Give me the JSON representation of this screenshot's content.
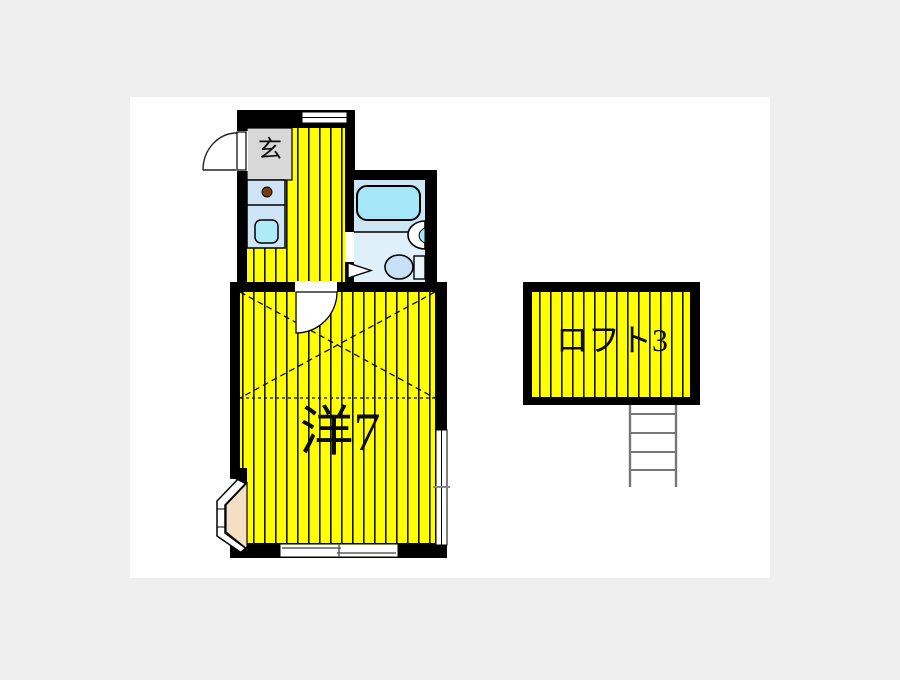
{
  "page": {
    "background_color": "#efefef",
    "canvas_color": "#ffffff"
  },
  "floorplan": {
    "kind": "japanese-apartment-floor-plan",
    "labels": {
      "entrance": "玄",
      "main_room": "洋7",
      "loft": "ロフト3"
    },
    "rooms": [
      {
        "id": "entrance-hall",
        "label": "玄"
      },
      {
        "id": "kitchen-corridor",
        "label": ""
      },
      {
        "id": "bathroom",
        "label": ""
      },
      {
        "id": "western-room",
        "label": "洋7",
        "size_mats": 7
      },
      {
        "id": "loft",
        "label": "ロフト3",
        "size_mats": 3
      }
    ],
    "fixtures": [
      "entrance-door",
      "kitchen-counter",
      "stove-burner",
      "kitchen-sink",
      "top-window",
      "bathtub",
      "washbasin",
      "toilet",
      "bathroom-door",
      "room-door",
      "loft-outline-dashed",
      "bay-window",
      "sliding-window-bottom",
      "sliding-window-right",
      "loft-ladder"
    ],
    "colors": {
      "wall": "#000000",
      "flooring_yellow": "#ffff00",
      "stripe_line": "#151500",
      "genkan_gray": "#d8d8d8",
      "counter_blue": "#cfe4f6",
      "sink_cyan": "#aeeaf7",
      "bathroom_floor": "#dff0fb",
      "bath_zone": "#cde6f5",
      "bathtub_cyan": "#a5e7f8",
      "toilet_blue": "#c8e0f5",
      "bay_window_beige": "#f5dfc4",
      "ladder_gray": "#777777"
    }
  }
}
